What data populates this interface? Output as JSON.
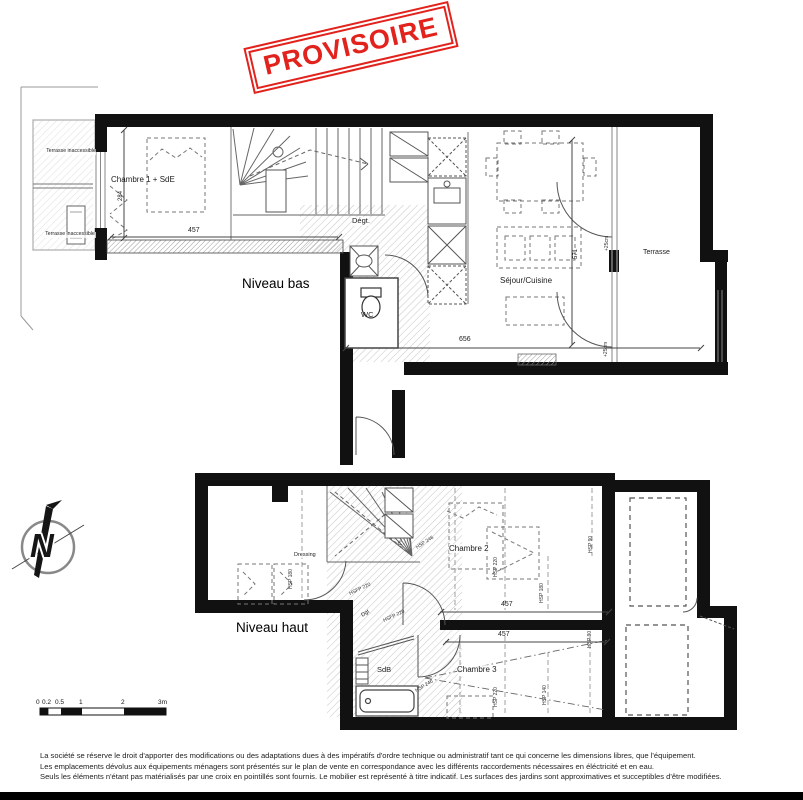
{
  "colors": {
    "stamp_red": "#e2221c",
    "wall": "#111111"
  },
  "stamp": {
    "text": "PROVISOIRE"
  },
  "plan_bas": {
    "title": "Niveau bas",
    "labels": {
      "terrasse_inaccessible_1": "Terrasse inaccessible",
      "terrasse_inaccessible_2": "Terrasse inaccessible",
      "chambre1": "Chambre 1 + SdE",
      "degt": "Dégt.",
      "wc": "WC",
      "sejour_cuisine": "Séjour/Cuisine",
      "terrasse": "Terrasse"
    },
    "dims": {
      "w457": "457",
      "h284": "284",
      "w656": "656",
      "h571": "571",
      "offset25_a": "+25cm",
      "offset25_b": "+25cm"
    }
  },
  "plan_haut": {
    "title": "Niveau haut",
    "labels": {
      "dressing": "Dressing",
      "placard": "Pl.",
      "chambre2": "Chambre 2",
      "dgt": "Dgt",
      "sdb": "SdB",
      "chambre3": "Chambre 3"
    },
    "dims": {
      "hsp_dressing": "HSP 180",
      "c2_hsp246": "HSP 246",
      "c2_hsp220": "HSP 220",
      "c2_hsp180": "HSP 180",
      "c2_hsp90": "HSP 90",
      "c2_w457": "457",
      "hsfp220_a": "HSFP 220",
      "hsfp220_b": "HSFP 220",
      "c3_hsp246": "HSP 246",
      "c3_hsp220": "HSP 220",
      "c3_hsp140": "HSP 140",
      "c3_hsp90": "HSP 90",
      "c3_w457": "457"
    }
  },
  "compass": {
    "letter": "N"
  },
  "scale_bar": {
    "ticks": [
      "0",
      "0.2",
      "0.5",
      "1",
      "2",
      "3m"
    ]
  },
  "footer": {
    "line1": "La société se réserve le droit  d'apporter des modifications ou des adaptations dues à des impératifs d'ordre technique ou administratif tant ce qui concerne les dimensions libres, que l'équipement.",
    "line2": "Les emplacements dévolus aux équipements ménagers sont présentés sur le plan de vente en correspondance avec les différents raccordements nécessaires en éléctricité et en eau.",
    "line3": "Seuls les éléments n'étant pas matérialisés par une croix en pointillés sont fournis. Le mobilier est représenté à titre indicatif. Les surfaces des jardins sont approximatives et succeptibles d'être modifiées."
  }
}
